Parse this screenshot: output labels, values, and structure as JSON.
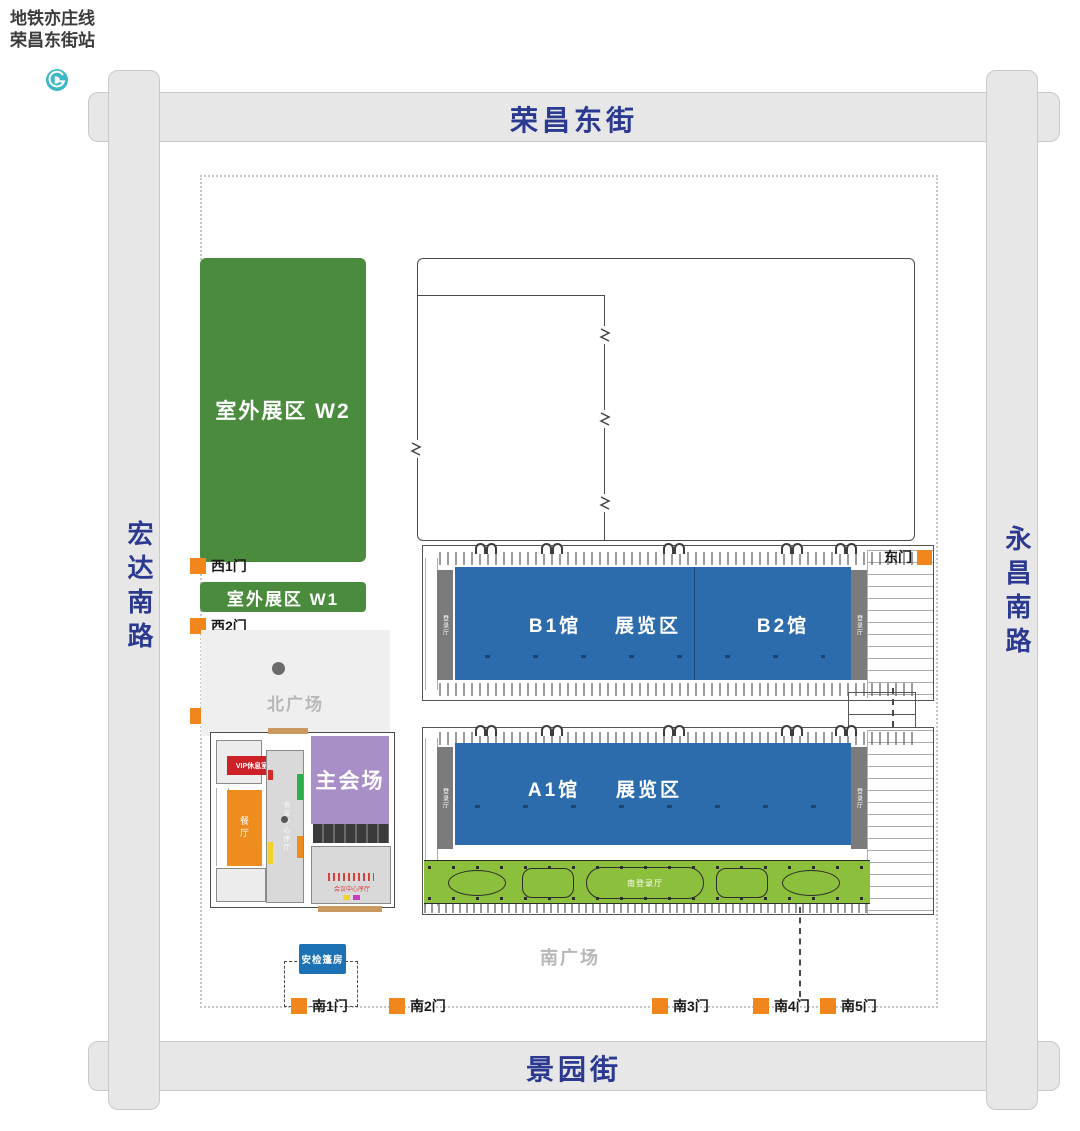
{
  "metro": {
    "line": "地铁亦庄线",
    "station": "荣昌东街站"
  },
  "streets": {
    "north": "荣昌东街",
    "south": "景园街",
    "west": "宏达南路",
    "east": "永昌南路"
  },
  "plazas": {
    "north": "北广场",
    "south": "南广场"
  },
  "outdoor": {
    "w2": "室外展区 W2",
    "w1": "室外展区 W1"
  },
  "halls": {
    "b1": "B1馆",
    "b2": "B2馆",
    "a1": "A1馆",
    "zone": "展览区"
  },
  "facilities": {
    "main_venue": "主会场",
    "vip_lounge": "VIP休息室",
    "restaurant": "餐厅",
    "conference_lobby": "会议中心序厅",
    "registration": "登录厅",
    "south_lobby": "南登录厅",
    "security_tent": "安检篷房"
  },
  "gates": {
    "west": [
      "西1门",
      "西2门",
      "西3门"
    ],
    "south": [
      "南1门",
      "南2门",
      "南3门",
      "南4门",
      "南5门"
    ],
    "east": "东门"
  },
  "colors": {
    "street_label": "#2b3990",
    "outdoor_green": "#4a8b3d",
    "hall_blue": "#2d6cac",
    "landscape_green": "#8cbf3b",
    "venue_purple": "#a88fc7",
    "gate_orange": "#f0861c",
    "vip_red": "#cb2127",
    "tent_blue": "#1d71b5",
    "metro_teal": "#3db8c6"
  }
}
